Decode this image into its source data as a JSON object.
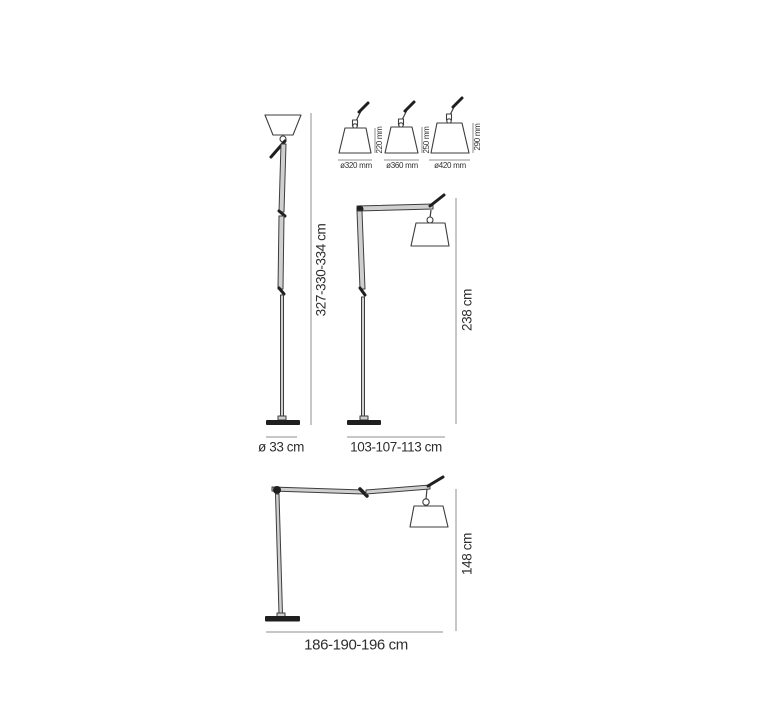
{
  "canvas": {
    "background": "#ffffff"
  },
  "colors": {
    "line": "#3d3d3d",
    "metal": "#cfcfcf",
    "dark": "#1f1f1f",
    "dim": "#8f8f8f",
    "text": "#2e2e2e"
  },
  "uplighter": {
    "name": "tall-uplighter-floor-lamp",
    "height_label": "327-330-334 cm",
    "base_diameter_label": "ø 33 cm"
  },
  "cantilever": {
    "name": "cantilever-floor-lamp-with-shade",
    "height_label": "238 cm",
    "reach_label": "103-107-113 cm"
  },
  "reading": {
    "name": "wide-cantilever-floor-lamp",
    "height_label": "148 cm",
    "reach_label": "186-190-196 cm"
  },
  "shade_options": [
    {
      "diameter_label": "ø320 mm",
      "height_label": "220 mm"
    },
    {
      "diameter_label": "ø360 mm",
      "height_label": "250 mm"
    },
    {
      "diameter_label": "ø420 mm",
      "height_label": "290 mm"
    }
  ]
}
